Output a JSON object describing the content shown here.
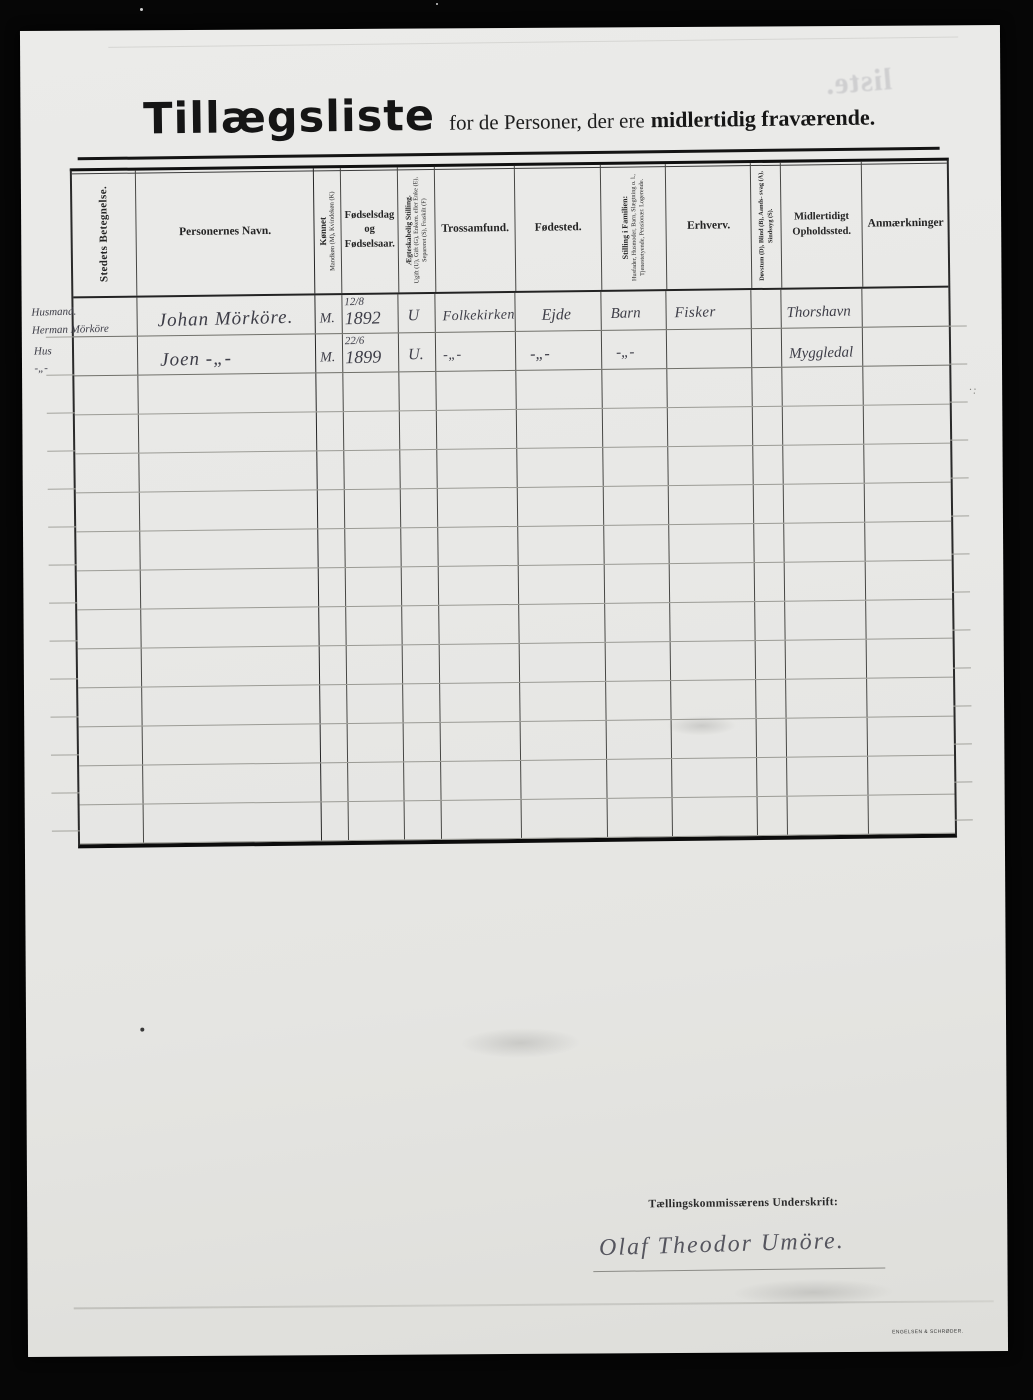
{
  "document": {
    "title": "Tillægsliste",
    "subtitle": "for de Personer, der ere",
    "subtitle_bold": "midlertidig fraværende.",
    "bleedthrough_text": "liste."
  },
  "table": {
    "columns": [
      {
        "id": "stedets-betegnelse",
        "label": "Stedets Betegnelse.",
        "vertical": true,
        "width": 64
      },
      {
        "id": "personernes-navn",
        "label": "Personernes Navn.",
        "vertical": false,
        "width": 178
      },
      {
        "id": "koennet",
        "label": "Kønnet",
        "sub": "Mandkøn (M), Kvindekøn (K)",
        "vertical": true,
        "width": 27
      },
      {
        "id": "foedselsdag",
        "label": "Fødselsdag og Fødselsaar.",
        "vertical": false,
        "width": 56
      },
      {
        "id": "aegteskabelig-stilling",
        "label": "Ægteskabelig Stilling.",
        "sub": "Ugift (U), Gift (G), Enkem. eller Enke (E), Separeret (S), Fraskilt (F)",
        "vertical": true,
        "width": 37
      },
      {
        "id": "trossamfund",
        "label": "Trossamfund.",
        "vertical": false,
        "width": 80
      },
      {
        "id": "foedested",
        "label": "Fødested.",
        "vertical": false,
        "width": 86
      },
      {
        "id": "stilling-i-familien",
        "label": "Stilling i Familien:",
        "sub": "Husfader, Husmoder, Barn, Slægtning o. l., Tjenestetyende, Pensionær. Logerende.",
        "vertical": true,
        "width": 65
      },
      {
        "id": "erhverv",
        "label": "Erhverv.",
        "vertical": false,
        "width": 85
      },
      {
        "id": "doevstum",
        "label": "Døvstum (D), Blind (B), Aands- svag (A), Sindssyg (S).",
        "vertical": true,
        "width": 30
      },
      {
        "id": "midlertidigt-opholdssted",
        "label": "Midlertidigt Opholdssted.",
        "vertical": false,
        "width": 81
      },
      {
        "id": "anmaerkninger",
        "label": "Anmærkninger",
        "vertical": false,
        "width": 86
      }
    ],
    "rows": [
      {
        "cells": [
          "Husmand.\nHerman Mörköre",
          "Johan Mörköre.",
          "M.",
          "12/8 1892",
          "U",
          "Folkekirken",
          "Ejde",
          "Barn",
          "Fisker",
          "",
          "Thorshavn",
          ""
        ]
      },
      {
        "cells": [
          "Hus\n -„-",
          "Joen  -„-",
          "M.",
          "22/6 1899",
          "U.",
          "-„-",
          "-„-",
          "-„-",
          "",
          "",
          "Myggledal",
          ""
        ]
      }
    ],
    "empty_row_count": 12
  },
  "footer": {
    "signature_label": "Tællingskommissærens Underskrift:",
    "signature": "Olaf Theodor Umöre.",
    "printer_mark": "ENGELSEN & SCHRØDER."
  },
  "colors": {
    "paper": "#e9e9e7",
    "ink": "#1d1d1d",
    "handwriting": "#3d3d47",
    "rule_line": "#9b9b95",
    "border": "#101010"
  }
}
